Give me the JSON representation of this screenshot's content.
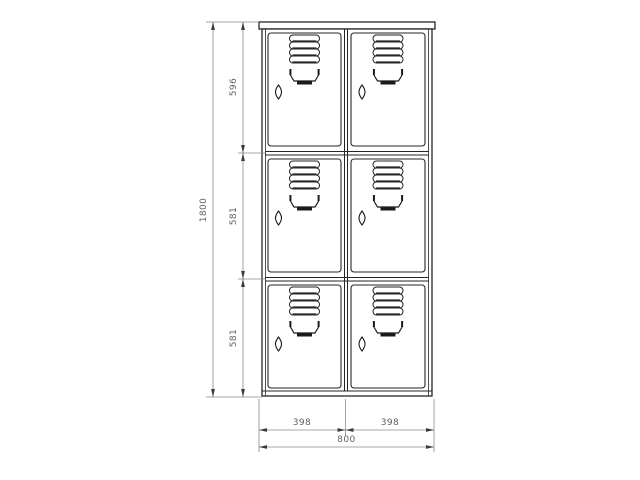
{
  "drawing": {
    "kind": "technical dimension drawing",
    "subject": "locker cabinet front elevation",
    "rows": 3,
    "columns": 2,
    "door_count": 6
  },
  "colors": {
    "background": "#ffffff",
    "outline": "#262626",
    "dimension_line": "#8a8a8a",
    "arrow": "#3a3a3a",
    "dimension_text": "#5f5f5f"
  },
  "dims": {
    "height": {
      "label": "1800",
      "orientation": "vertical"
    },
    "segments": [
      {
        "label": "596",
        "orientation": "vertical"
      },
      {
        "label": "581",
        "orientation": "vertical"
      },
      {
        "label": "581",
        "orientation": "vertical"
      }
    ],
    "widths": [
      {
        "label": "398",
        "orientation": "horizontal"
      },
      {
        "label": "398",
        "orientation": "horizontal"
      }
    ],
    "total_width": {
      "label": "800",
      "orientation": "horizontal"
    }
  },
  "icons": {
    "vent_louvers": "four stacked ventilation slats",
    "door_handle": "recessed pull handle",
    "keyhole": "vertical lens-shaped keyhole"
  }
}
